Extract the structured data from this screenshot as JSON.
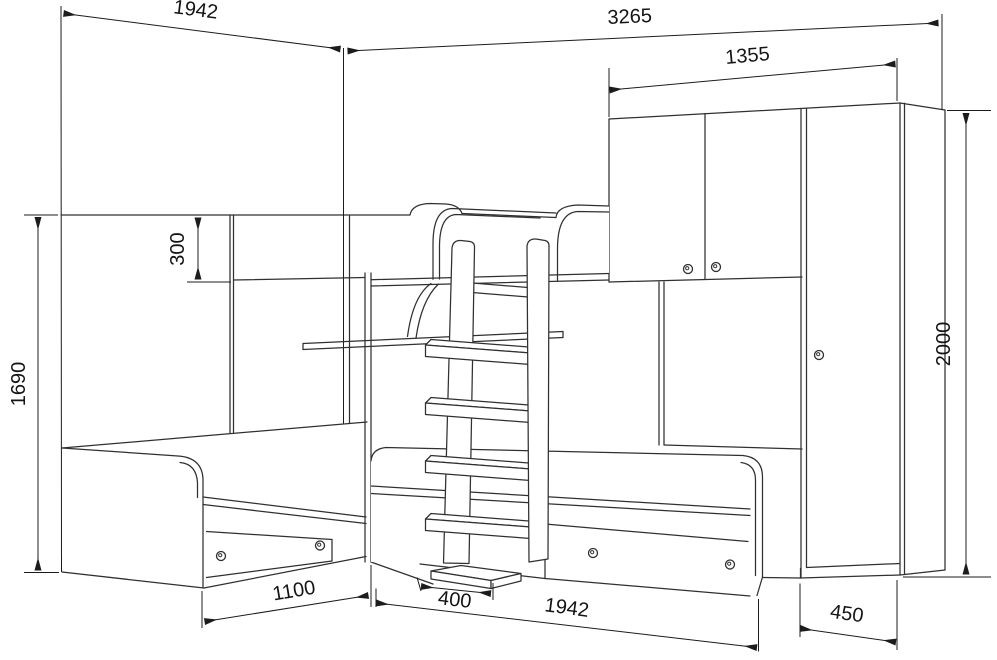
{
  "drawing": {
    "type": "furniture-technical-drawing",
    "subject": "corner bunk-bed set with two lower beds, drawers, ladder, shelf and wardrobe",
    "units": "mm",
    "colors": {
      "line": "#303030",
      "dimension": "#1c1c1c",
      "background": "#ffffff"
    },
    "dimensions": {
      "left_bed_length": "1942",
      "overall_right_width": "3265",
      "wardrobe_total_width": "1355",
      "upper_guard_height": "300",
      "left_section_height": "1690",
      "wardrobe_height": "2000",
      "left_bed_front_width": "1100",
      "ladder_offset": "400",
      "right_bed_length": "1942",
      "wardrobe_door_width": "450"
    }
  }
}
